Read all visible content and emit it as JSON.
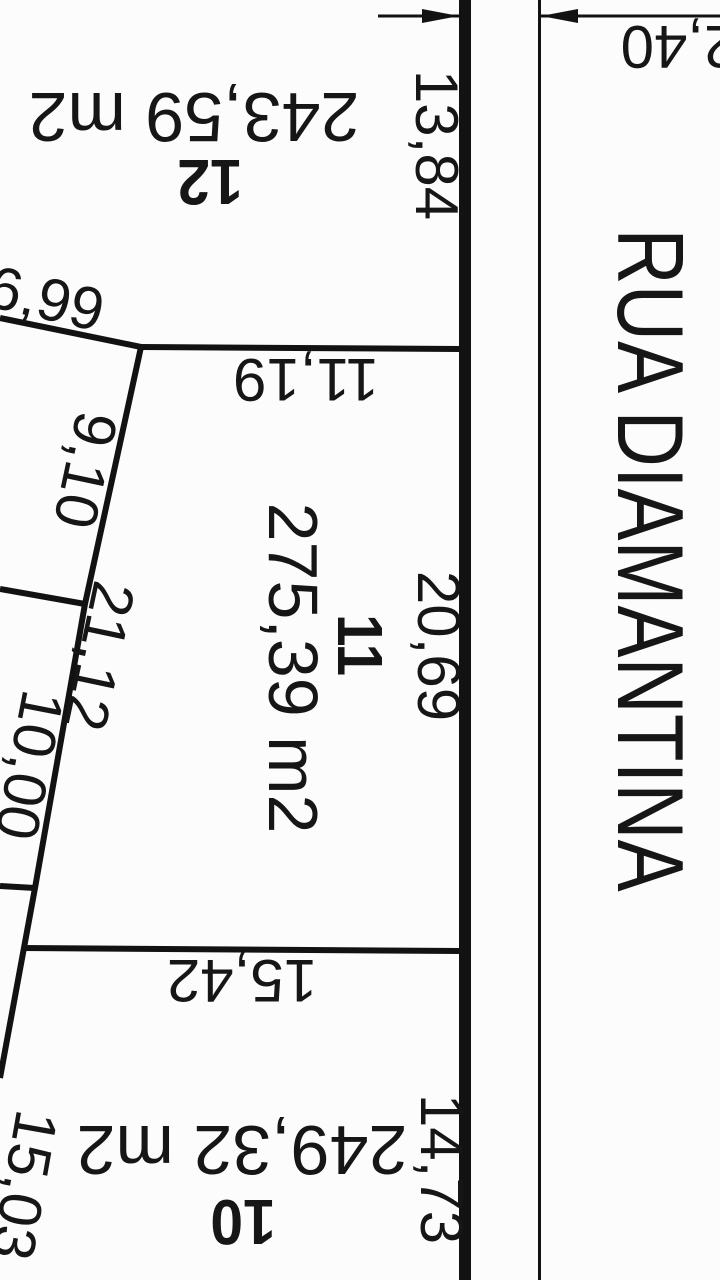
{
  "colors": {
    "ink": "#121212",
    "paper": "#fcfcfc"
  },
  "street": {
    "name": "RUA DIAMANTINA"
  },
  "setback": {
    "width_label": "2,40"
  },
  "lots": [
    {
      "number": "12",
      "area_label": "243,59 m2",
      "frontage_label": "13,84"
    },
    {
      "number": "11",
      "area_label": "275,39 m2",
      "frontage_label": "20,69",
      "north_boundary_label": "11,19",
      "west_side_label": "21,12",
      "south_boundary_label": "15,42"
    },
    {
      "number": "10",
      "area_label": "249,32 m2",
      "frontage_label": "14,73"
    }
  ],
  "west_neighbors": {
    "boundary_1_label": "6,99",
    "boundary_2_label": "9,10",
    "boundary_3_label": "10,00",
    "boundary_4_label": "15,03"
  }
}
